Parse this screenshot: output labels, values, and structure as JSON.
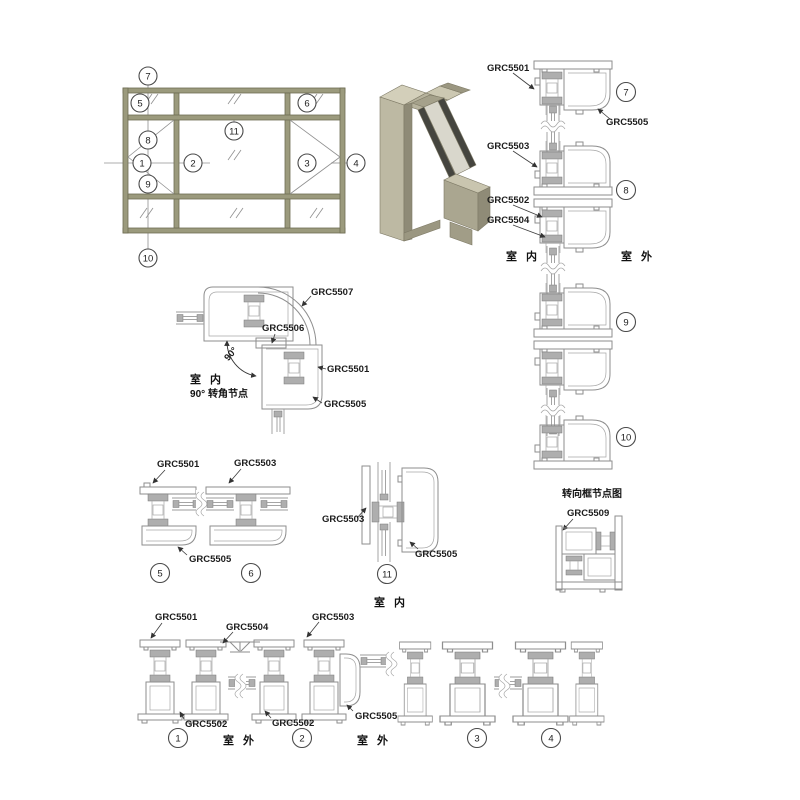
{
  "colors": {
    "line_gray": "#8e8e8e",
    "leader_dark": "#3c3c3c",
    "label_text": "#1c1c1c",
    "frame_khaki_fill": "#9b9a7d",
    "frame_khaki_stroke": "#6e6d54",
    "metal_light": "#d3cfba",
    "metal_mid": "#b2ae98",
    "metal_dark": "#8f8b77",
    "glass_dark": "#45453f",
    "background": "#ffffff"
  },
  "elevation": {
    "balloons": {
      "b1": "1",
      "b2": "2",
      "b3": "3",
      "b4": "4",
      "b5": "5",
      "b6": "6",
      "b7": "7",
      "b8": "8",
      "b9": "9",
      "b10": "10",
      "b11": "11"
    }
  },
  "right_column": {
    "grc5501": "GRC5501",
    "grc5505": "GRC5505",
    "grc5503": "GRC5503",
    "grc5502": "GRC5502",
    "grc5504": "GRC5504",
    "b7": "7",
    "b8": "8",
    "b9": "9",
    "b10": "10",
    "indoor": "室 内",
    "outdoor": "室 外"
  },
  "corner": {
    "grc5507": "GRC5507",
    "grc5506": "GRC5506",
    "grc5501": "GRC5501",
    "grc5505": "GRC5505",
    "angle": "90°",
    "indoor": "室 内",
    "caption": "90° 转角节点"
  },
  "mid": {
    "grc5501": "GRC5501",
    "grc5503": "GRC5503",
    "grc5505": "GRC5505",
    "b5": "5",
    "b6": "6"
  },
  "sec11": {
    "grc5503": "GRC5503",
    "grc5505": "GRC5505",
    "b11": "11",
    "indoor": "室 内"
  },
  "turning": {
    "title": "转向框节点图",
    "grc5509": "GRC5509"
  },
  "bottom": {
    "grc5501": "GRC5501",
    "grc5504": "GRC5504",
    "grc5503": "GRC5503",
    "grc5502a": "GRC5502",
    "grc5502b": "GRC5502",
    "grc5505": "GRC5505",
    "b1": "1",
    "b2": "2",
    "b3": "3",
    "b4": "4",
    "outdoor_a": "室 外",
    "outdoor_b": "室 外"
  }
}
